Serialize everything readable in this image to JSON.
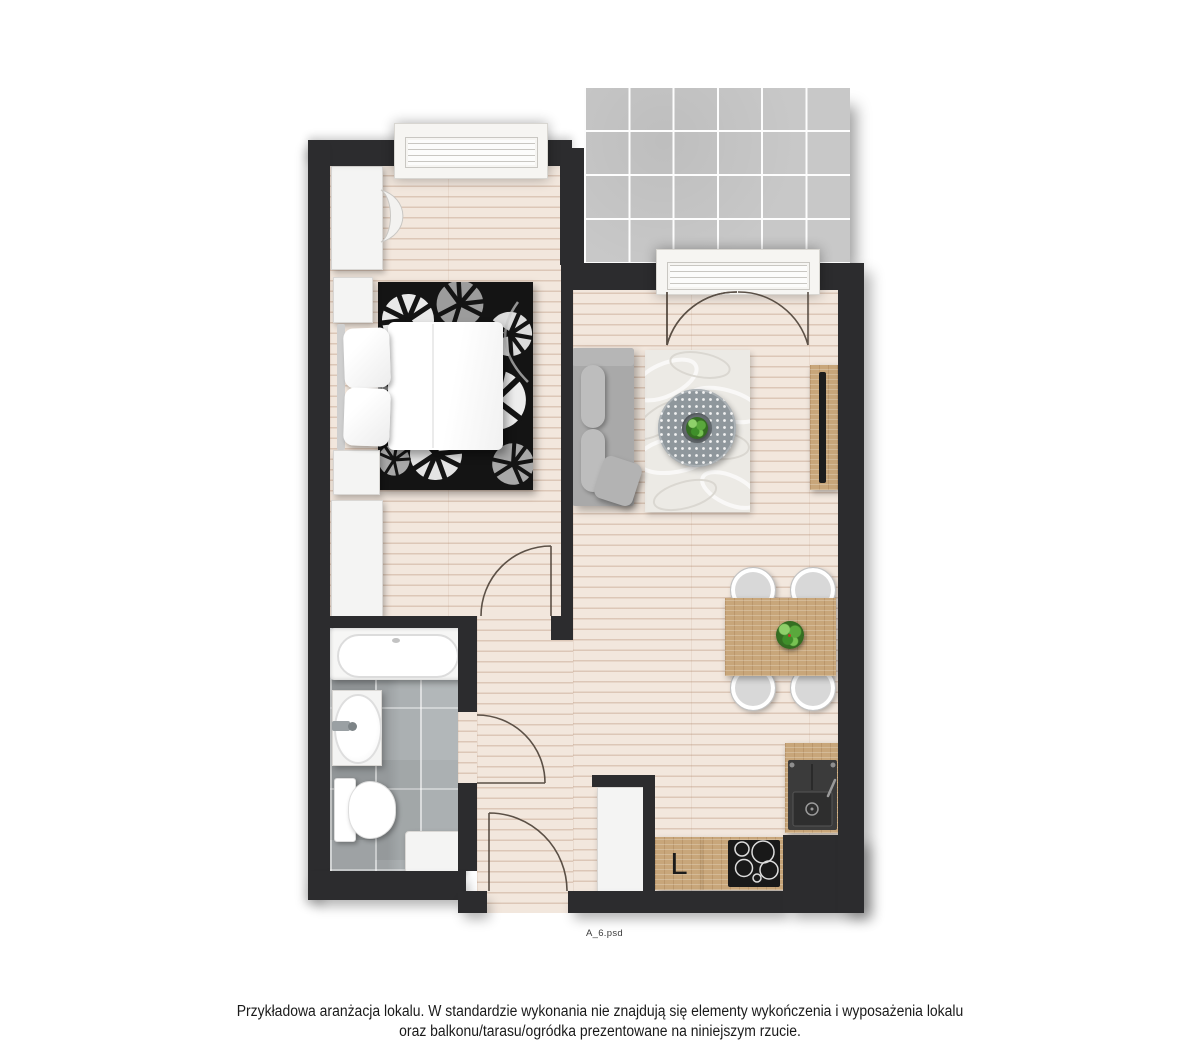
{
  "caption": {
    "line1": "Przykładowa aranżacja lokalu. W standardzie wykonania nie znajdują się elementy wykończenia i wyposażenia lokalu",
    "line2": "oraz balkonu/tarasu/ogródka prezentowane na niniejszym rzucie."
  },
  "plan": {
    "fridge_label": "L",
    "file_label": "A_6.psd"
  },
  "palette": {
    "wall": "#2c2c2e",
    "floor_wood": "#f2e7dd",
    "bath_tile": "#a6abad",
    "balcony_tile": "#c8c8c8",
    "furniture_wood": "#c8a67a",
    "sofa_gray": "#a9a9a9",
    "accent_plant": "#5aa83c",
    "text": "#1a1a1a"
  }
}
